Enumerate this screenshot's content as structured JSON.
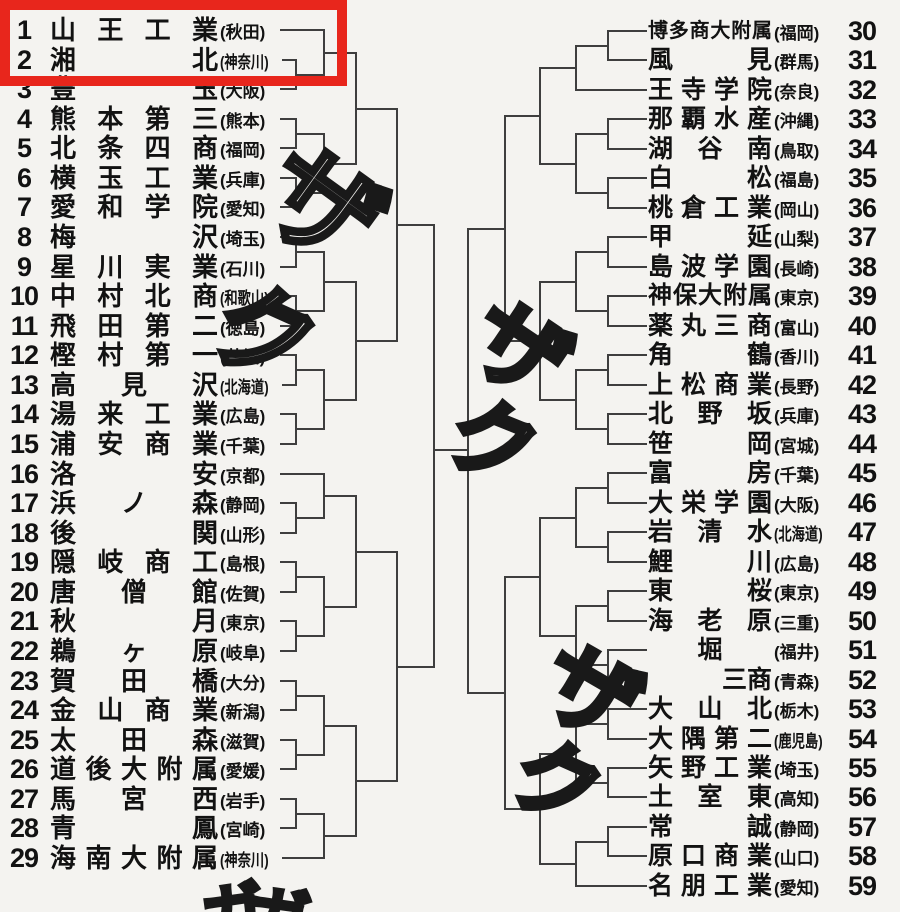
{
  "page": {
    "background": "#f4f3f0",
    "line_color": "#3e3e3e",
    "text_color": "#121212"
  },
  "highlight": {
    "color": "#e8261c",
    "covers_seeds": [
      1,
      2
    ],
    "x": 0,
    "y": 0,
    "width": 347,
    "height": 86,
    "border": 10
  },
  "teams": {
    "left": [
      {
        "seed": 1,
        "name": "山王工業",
        "pref": "秋田"
      },
      {
        "seed": 2,
        "name": "湘北",
        "pref": "神奈川"
      },
      {
        "seed": 3,
        "name": "豊玉",
        "pref": "大阪"
      },
      {
        "seed": 4,
        "name": "熊本第三",
        "pref": "熊本"
      },
      {
        "seed": 5,
        "name": "北条四商",
        "pref": "福岡"
      },
      {
        "seed": 6,
        "name": "横玉工業",
        "pref": "兵庫"
      },
      {
        "seed": 7,
        "name": "愛和学院",
        "pref": "愛知"
      },
      {
        "seed": 8,
        "name": "梅沢",
        "pref": "埼玉"
      },
      {
        "seed": 9,
        "name": "星川実業",
        "pref": "石川"
      },
      {
        "seed": 10,
        "name": "中村北商",
        "pref": "和歌山"
      },
      {
        "seed": 11,
        "name": "飛田第二",
        "pref": "徳島"
      },
      {
        "seed": 12,
        "name": "樫村第一",
        "pref": "茨城"
      },
      {
        "seed": 13,
        "name": "高見沢",
        "pref": "北海道"
      },
      {
        "seed": 14,
        "name": "湯来工業",
        "pref": "広島"
      },
      {
        "seed": 15,
        "name": "浦安商業",
        "pref": "千葉"
      },
      {
        "seed": 16,
        "name": "洛安",
        "pref": "京都"
      },
      {
        "seed": 17,
        "name": "浜ノ森",
        "pref": "静岡"
      },
      {
        "seed": 18,
        "name": "後関",
        "pref": "山形"
      },
      {
        "seed": 19,
        "name": "隠岐商工",
        "pref": "島根"
      },
      {
        "seed": 20,
        "name": "唐僧館",
        "pref": "佐賀"
      },
      {
        "seed": 21,
        "name": "秋月",
        "pref": "東京"
      },
      {
        "seed": 22,
        "name": "鵜ヶ原",
        "pref": "岐阜"
      },
      {
        "seed": 23,
        "name": "賀田橋",
        "pref": "大分"
      },
      {
        "seed": 24,
        "name": "金山商業",
        "pref": "新潟"
      },
      {
        "seed": 25,
        "name": "太田森",
        "pref": "滋賀"
      },
      {
        "seed": 26,
        "name": "道後大附属",
        "pref": "愛媛"
      },
      {
        "seed": 27,
        "name": "馬宮西",
        "pref": "岩手"
      },
      {
        "seed": 28,
        "name": "青鳳",
        "pref": "宮崎"
      },
      {
        "seed": 29,
        "name": "海南大附属",
        "pref": "神奈川"
      }
    ],
    "right": [
      {
        "seed": 30,
        "name": "博多商大附属",
        "pref": "福岡"
      },
      {
        "seed": 31,
        "name": "風見",
        "pref": "群馬"
      },
      {
        "seed": 32,
        "name": "王寺学院",
        "pref": "奈良"
      },
      {
        "seed": 33,
        "name": "那覇水産",
        "pref": "沖縄"
      },
      {
        "seed": 34,
        "name": "湖谷南",
        "pref": "鳥取"
      },
      {
        "seed": 35,
        "name": "白松",
        "pref": "福島"
      },
      {
        "seed": 36,
        "name": "桃倉工業",
        "pref": "岡山"
      },
      {
        "seed": 37,
        "name": "甲延",
        "pref": "山梨"
      },
      {
        "seed": 38,
        "name": "島波学園",
        "pref": "長崎"
      },
      {
        "seed": 39,
        "name": "神保大附属",
        "pref": "東京"
      },
      {
        "seed": 40,
        "name": "薬丸三商",
        "pref": "富山"
      },
      {
        "seed": 41,
        "name": "角鶴",
        "pref": "香川"
      },
      {
        "seed": 42,
        "name": "上松商業",
        "pref": "長野"
      },
      {
        "seed": 43,
        "name": "北野坂",
        "pref": "兵庫"
      },
      {
        "seed": 44,
        "name": "笹岡",
        "pref": "宮城"
      },
      {
        "seed": 45,
        "name": "富房",
        "pref": "千葉"
      },
      {
        "seed": 46,
        "name": "大栄学園",
        "pref": "大阪"
      },
      {
        "seed": 47,
        "name": "岩清水",
        "pref": "北海道"
      },
      {
        "seed": 48,
        "name": "鯉川",
        "pref": "広島"
      },
      {
        "seed": 49,
        "name": "東桜",
        "pref": "東京"
      },
      {
        "seed": 50,
        "name": "海老原",
        "pref": "三重"
      },
      {
        "seed": 51,
        "name": "堀",
        "pref": "福井",
        "align": "center"
      },
      {
        "seed": 52,
        "name": "三商",
        "pref": "青森",
        "align": "right",
        "obscured": true
      },
      {
        "seed": 53,
        "name": "大山北",
        "pref": "栃木"
      },
      {
        "seed": 54,
        "name": "大隅第二",
        "pref": "鹿児島"
      },
      {
        "seed": 55,
        "name": "矢野工業",
        "pref": "埼玉"
      },
      {
        "seed": 56,
        "name": "土室東",
        "pref": "高知"
      },
      {
        "seed": 57,
        "name": "常誠",
        "pref": "静岡"
      },
      {
        "seed": 58,
        "name": "原口商業",
        "pref": "山口"
      },
      {
        "seed": 59,
        "name": "名朋工業",
        "pref": "愛知"
      }
    ]
  },
  "pairings": {
    "left": [
      [
        1
      ],
      [
        2,
        3
      ],
      [
        4,
        5
      ],
      [
        6,
        7
      ],
      [
        8,
        9
      ],
      [
        10,
        11
      ],
      [
        12,
        13
      ],
      [
        14,
        15
      ],
      [
        16
      ],
      [
        17,
        18
      ],
      [
        19,
        20
      ],
      [
        21,
        22
      ],
      [
        23,
        24
      ],
      [
        25,
        26
      ],
      [
        27,
        28
      ],
      [
        29
      ]
    ],
    "right": [
      [
        30,
        31
      ],
      [
        32
      ],
      [
        33,
        34
      ],
      [
        35,
        36
      ],
      [
        37,
        38
      ],
      [
        39,
        40
      ],
      [
        41,
        42
      ],
      [
        43,
        44
      ],
      [
        45,
        46
      ],
      [
        47,
        48
      ],
      [
        49,
        50
      ],
      [
        51,
        52
      ],
      [
        53,
        54
      ],
      [
        55,
        56
      ],
      [
        57,
        58
      ],
      [
        59
      ]
    ]
  },
  "handwritten_sfx": [
    {
      "ch": "ザ",
      "x": 308,
      "y": 128,
      "size": 115,
      "rot": 36
    },
    {
      "ch": "ク",
      "x": 238,
      "y": 268,
      "size": 102,
      "rot": 24
    },
    {
      "ch": "ザ",
      "x": 505,
      "y": 286,
      "size": 95,
      "rot": 34
    },
    {
      "ch": "ク",
      "x": 468,
      "y": 386,
      "size": 88,
      "rot": 22
    },
    {
      "ch": "ザ",
      "x": 572,
      "y": 630,
      "size": 95,
      "rot": 30
    },
    {
      "ch": "ク",
      "x": 534,
      "y": 726,
      "size": 88,
      "rot": 24
    },
    {
      "ch": "ガ",
      "x": 198,
      "y": 888,
      "size": 62,
      "rot": -8,
      "clipped": true
    },
    {
      "ch": "ガ",
      "x": 252,
      "y": 884,
      "size": 62,
      "rot": 8,
      "clipped": true
    }
  ]
}
